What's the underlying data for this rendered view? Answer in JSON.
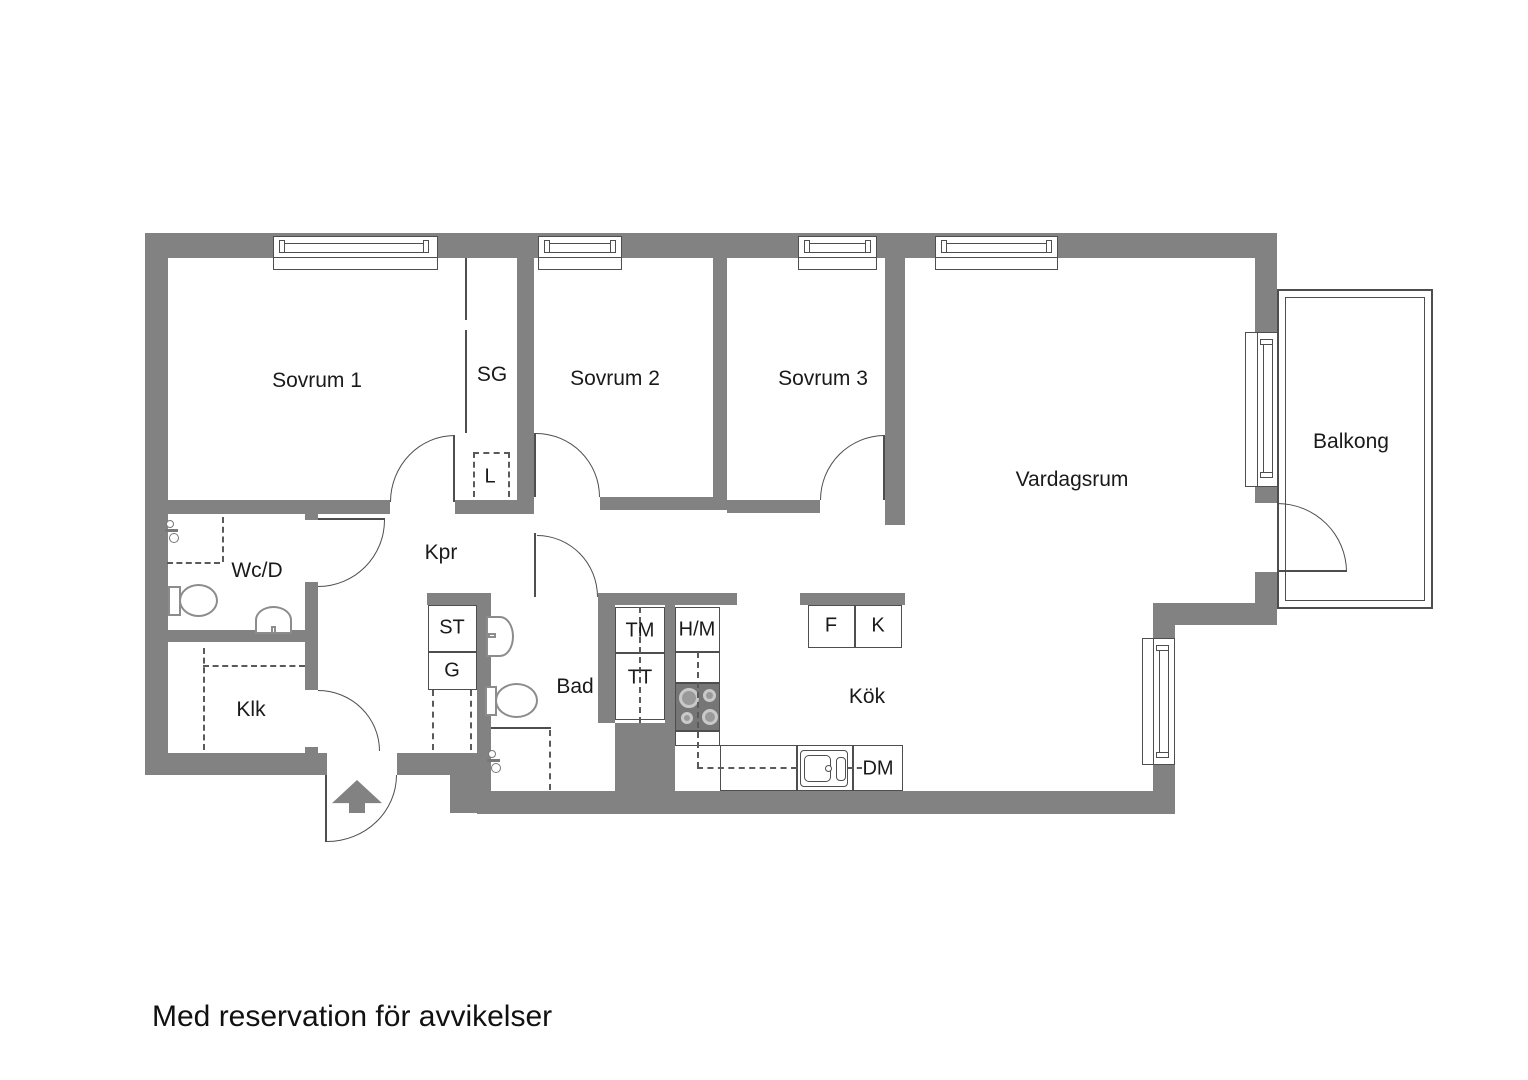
{
  "plan": {
    "rooms": {
      "sovrum1": "Sovrum 1",
      "sg": "SG",
      "sovrum2": "Sovrum 2",
      "sovrum3": "Sovrum 3",
      "vardagsrum": "Vardagsrum",
      "balkong": "Balkong",
      "wcd": "Wc/D",
      "kpr": "Kpr",
      "klk": "Klk",
      "bad": "Bad",
      "kok": "Kök"
    },
    "fixtures": {
      "st": "ST",
      "g": "G",
      "l": "L",
      "tm": "TM",
      "tt": "TT",
      "hm": "H/M",
      "f": "F",
      "k": "K",
      "dm": "DM"
    },
    "disclaimer": "Med reservation för avvikelser",
    "colors": {
      "wall": "#828282",
      "line": "#4e4e4e",
      "text": "#1a1a1a"
    }
  }
}
